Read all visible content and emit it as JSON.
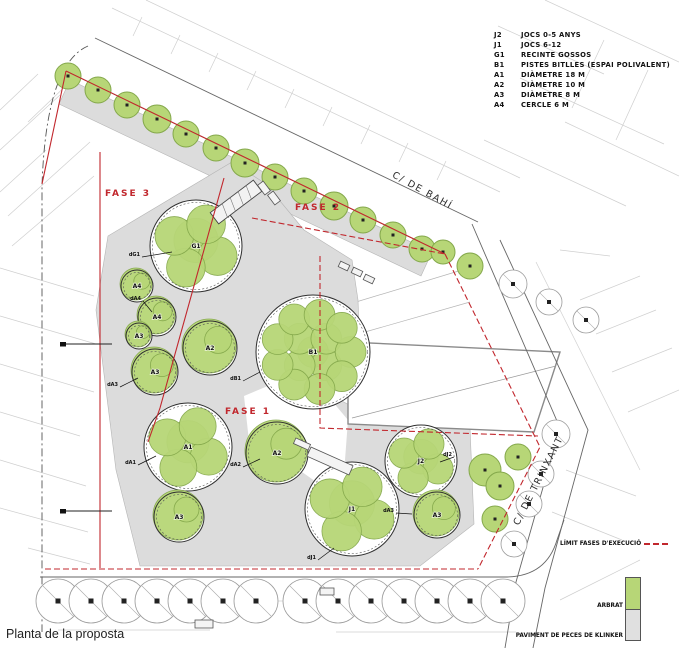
{
  "title_caption": "Planta de la proposta",
  "legend": {
    "items": [
      {
        "code": "J2",
        "label": "JOCS 0-5 ANYS"
      },
      {
        "code": "J1",
        "label": "JOCS 6-12"
      },
      {
        "code": "G1",
        "label": "RECINTE GOSSOS"
      },
      {
        "code": "B1",
        "label": "PISTES BITLLES (ESPAI POLIVALENT)"
      },
      {
        "code": "A1",
        "label": "DIÀMETRE 18 M"
      },
      {
        "code": "A2",
        "label": "DIÀMETRE 10 M"
      },
      {
        "code": "A3",
        "label": "DIÀMETRE  8 M"
      },
      {
        "code": "A4",
        "label": "CERCLE      6 M"
      }
    ]
  },
  "legend2": {
    "limit": "LÍMIT FASES D'EXECUCIÓ",
    "arbrat": "ARBRAT",
    "paviment": "PAVIMENT DE PECES DE KLINKER"
  },
  "streets": {
    "bahi": "C/ DE BAHÍ",
    "trinxant": "C/ DE TRINXANT"
  },
  "phases": [
    {
      "label": "FASE 3"
    },
    {
      "label": "FASE 2"
    },
    {
      "label": "FASE 1"
    }
  ],
  "colors": {
    "tree_green": "#b7d677",
    "tree_stroke": "#84a84b",
    "paving": "#dcdcdc",
    "boundary_red": "#c1272d"
  },
  "plan": {
    "features": [
      {
        "code": "G1",
        "x": 196,
        "y": 246,
        "r": 46,
        "shape": "multi"
      },
      {
        "code": "A4",
        "x": 137,
        "y": 286,
        "r": 16,
        "shape": "single"
      },
      {
        "code": "A4",
        "x": 157,
        "y": 317,
        "r": 19,
        "shape": "single"
      },
      {
        "code": "A3",
        "x": 139,
        "y": 336,
        "r": 13,
        "shape": "single"
      },
      {
        "code": "A3",
        "x": 155,
        "y": 372,
        "r": 23,
        "shape": "single"
      },
      {
        "code": "A2",
        "x": 210,
        "y": 348,
        "r": 27,
        "shape": "single"
      },
      {
        "code": "B1",
        "x": 313,
        "y": 352,
        "r": 57,
        "shape": "b1"
      },
      {
        "code": "A1",
        "x": 188,
        "y": 447,
        "r": 44,
        "shape": "multi"
      },
      {
        "code": "A2",
        "x": 277,
        "y": 453,
        "r": 31,
        "shape": "single"
      },
      {
        "code": "A3",
        "x": 179,
        "y": 517,
        "r": 25,
        "shape": "single"
      },
      {
        "code": "J1",
        "x": 352,
        "y": 509,
        "r": 47,
        "shape": "multi"
      },
      {
        "code": "J2",
        "x": 421,
        "y": 461,
        "r": 36,
        "shape": "multi"
      },
      {
        "code": "A3",
        "x": 437,
        "y": 515,
        "r": 23,
        "shape": "single"
      }
    ],
    "green_trees": [
      [
        68,
        76,
        13
      ],
      [
        98,
        90,
        13
      ],
      [
        127,
        105,
        13
      ],
      [
        157,
        119,
        14
      ],
      [
        186,
        134,
        13
      ],
      [
        216,
        148,
        13
      ],
      [
        245,
        163,
        14
      ],
      [
        275,
        177,
        13
      ],
      [
        304,
        191,
        13
      ],
      [
        334,
        206,
        14
      ],
      [
        363,
        220,
        13
      ],
      [
        393,
        235,
        13
      ],
      [
        422,
        249,
        13
      ],
      [
        443,
        252,
        12
      ],
      [
        470,
        266,
        13
      ],
      [
        518,
        457,
        13
      ],
      [
        485,
        470,
        16
      ],
      [
        500,
        486,
        14
      ],
      [
        495,
        519,
        13
      ]
    ],
    "outline_trees": [
      [
        513,
        284,
        14
      ],
      [
        549,
        302,
        13
      ],
      [
        586,
        320,
        13
      ],
      [
        556,
        434,
        14
      ],
      [
        541,
        474,
        13
      ],
      [
        529,
        504,
        13
      ],
      [
        514,
        544,
        13
      ]
    ],
    "street_trees": [
      58,
      91,
      124,
      157,
      190,
      223,
      256,
      305,
      338,
      371,
      404,
      437,
      470,
      503
    ],
    "callouts": [
      {
        "t": "dG1",
        "x": 140,
        "y": 256,
        "ex": 172,
        "ey": 252
      },
      {
        "t": "dA4",
        "x": 141,
        "y": 300,
        "ex": 152,
        "ey": 312
      },
      {
        "t": "dA3",
        "x": 118,
        "y": 386,
        "ex": 138,
        "ey": 378
      },
      {
        "t": "dB1",
        "x": 241,
        "y": 380,
        "ex": 260,
        "ey": 372
      },
      {
        "t": "dA1",
        "x": 136,
        "y": 464,
        "ex": 156,
        "ey": 456
      },
      {
        "t": "dA2",
        "x": 241,
        "y": 466,
        "ex": 260,
        "ey": 459
      },
      {
        "t": "dJ2",
        "x": 452,
        "y": 456,
        "ex": 440,
        "ey": 462
      },
      {
        "t": "dA3",
        "x": 394,
        "y": 512,
        "ex": 412,
        "ey": 514
      },
      {
        "t": "dJ1",
        "x": 316,
        "y": 559,
        "ex": 334,
        "ey": 548
      }
    ],
    "section_markers": [
      {
        "x": 60,
        "y": 344
      },
      {
        "x": 60,
        "y": 511
      }
    ]
  }
}
